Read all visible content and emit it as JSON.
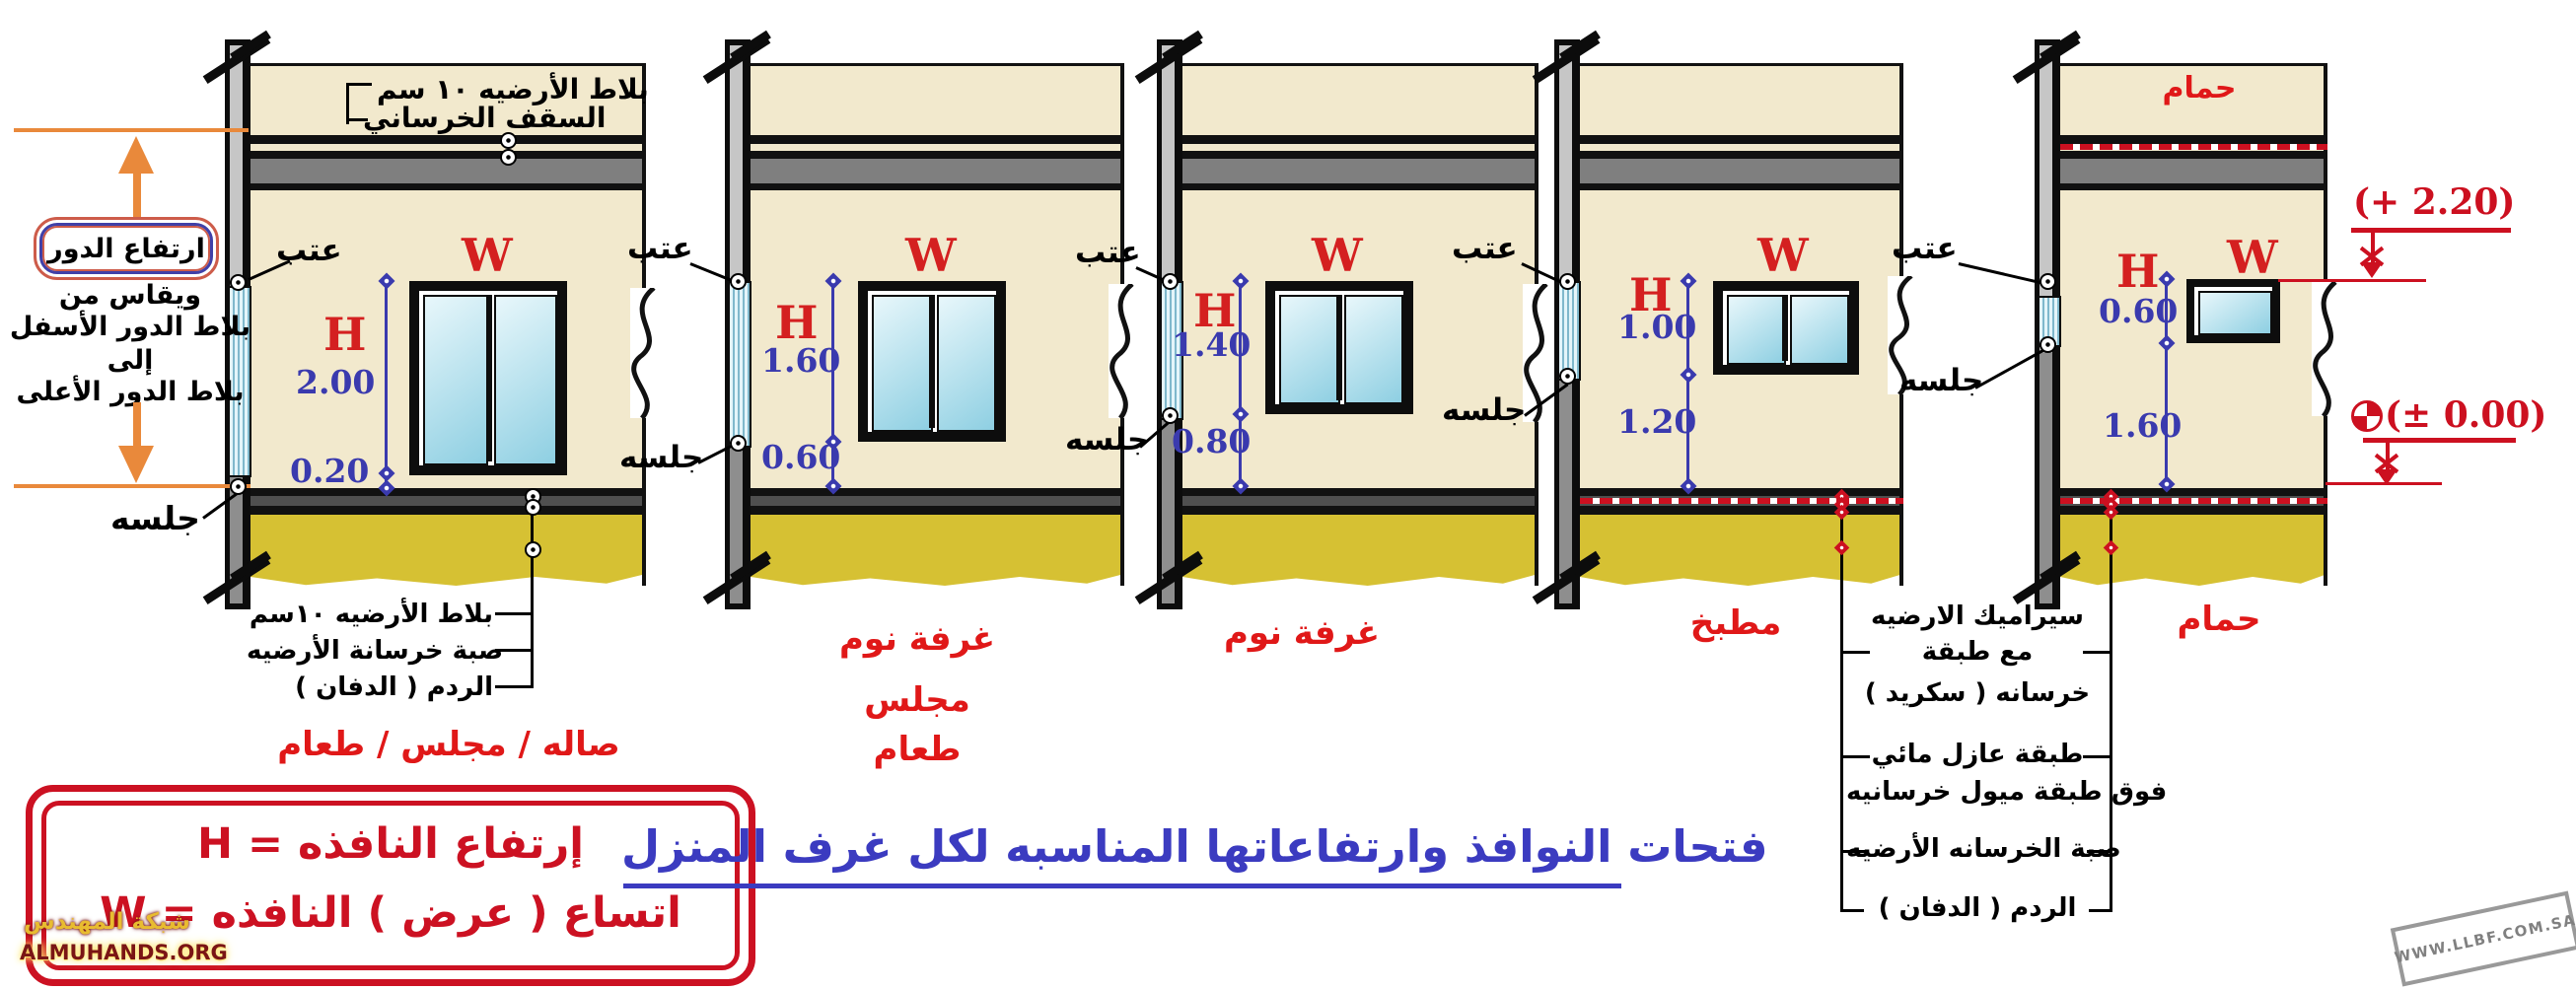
{
  "labels": {
    "lintel": "عتب",
    "sill": "جلسه",
    "w": "W",
    "h": "H"
  },
  "left_panel": {
    "floor_height_box": "ارتفاع الدور",
    "note_lines": [
      "ويقاس من",
      "بلاط الدور الأسفل",
      "إلى",
      "بلاط الدور الأعلى"
    ]
  },
  "top_notes": {
    "tiles": "بلاط الأرضيه ١٠ سم",
    "ceiling": "السقف الخرساني"
  },
  "bottom_notes": [
    "بلاط الأرضيه ١٠سم",
    "صبة خرسانة الأرضيه",
    "الردم ( الدفان )"
  ],
  "sections": [
    {
      "room_lines": [
        "صاله / مجلس / طعام"
      ],
      "h_value": "2.00",
      "sill_value": "0.20"
    },
    {
      "room_lines": [
        "غرفة نوم",
        "مجلس",
        "طعام"
      ],
      "h_value": "1.60",
      "sill_value": "0.60"
    },
    {
      "room_lines": [
        "غرفة نوم"
      ],
      "h_value": "1.40",
      "sill_value": "0.80"
    },
    {
      "room_lines": [
        "مطبخ"
      ],
      "h_value": "1.00",
      "sill_value": "1.20"
    },
    {
      "room_lines": [
        "حمام"
      ],
      "upper_room": "حمام",
      "h_value": "0.60",
      "sill_value": "1.60"
    }
  ],
  "floor_layers": [
    "سيراميك الارضيه",
    "مع طبقة",
    "خرسانه ( سكريد )",
    "طبقة عازل مائي",
    "فوق طبقة ميول خرسانيه",
    "صبة الخرسانه الأرضيه",
    "الردم ( الدفان )"
  ],
  "elevations": {
    "lintel_level": "(+ 2.20)",
    "datum_level": "(± 0.00)"
  },
  "legend": {
    "line1": "إرتفاع النافذه = H",
    "line2": "اتساع ( عرض ) النافذه = W"
  },
  "title": "فتحات النوافذ وارتفاعاتها المناسبه لكل غرف المنزل",
  "watermarks": {
    "site_ar": "شبكة المهندس",
    "site_en": "ALMUHANDS.ORG",
    "stamp": "WWW.LLBF.COM.SA"
  },
  "colors": {
    "wall": "#f2e9cd",
    "fill": "#d6c133",
    "accent_orange": "#e9893b",
    "dim_blue": "#3a3aae",
    "red": "#cc1020",
    "title_blue": "#3b3bc0"
  }
}
